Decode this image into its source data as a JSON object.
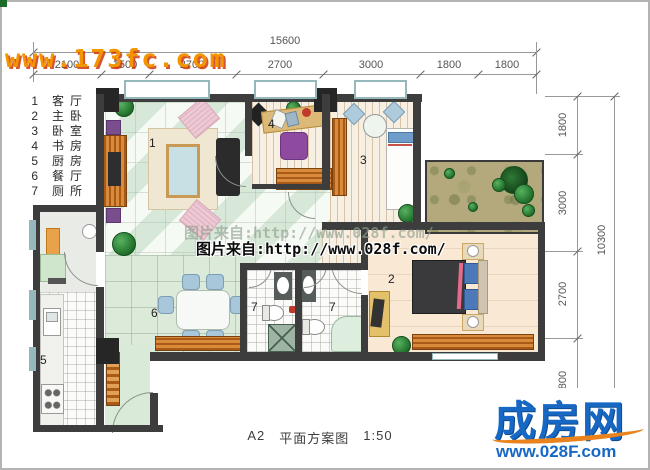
{
  "watermarks": {
    "site_top_left": "www.173fc.com",
    "source_center": "图片来自:http://www.028f.com/"
  },
  "legend": {
    "items": [
      {
        "num": "1",
        "label": "客厅"
      },
      {
        "num": "2",
        "label": "主卧"
      },
      {
        "num": "3",
        "label": "卧室"
      },
      {
        "num": "4",
        "label": "书房"
      },
      {
        "num": "5",
        "label": "厨房"
      },
      {
        "num": "6",
        "label": "餐厅"
      },
      {
        "num": "7",
        "label": "厕所"
      }
    ]
  },
  "dimensions": {
    "top": {
      "total": "15600",
      "segments": [
        "2100",
        "1500",
        "2700",
        "2700",
        "3000",
        "1800",
        "1800"
      ]
    },
    "right": {
      "total": "10300",
      "segments": [
        "1800",
        "3000",
        "2700",
        "800"
      ]
    }
  },
  "rooms": {
    "living": "1",
    "master": "2",
    "bedroom2": "3",
    "study": "4",
    "kitchen": "5",
    "dining": "6",
    "bath_left": "7",
    "bath_right": "7"
  },
  "footer": {
    "code": "A2",
    "title": "平面方案图",
    "scale": "1:50"
  },
  "logo": {
    "brand": "成房网",
    "site": "www.028F.com"
  },
  "colors": {
    "wall": "#3d3d3d",
    "window_frame": "#96b7bc",
    "wood": "#c06a1e",
    "logo_blue": "#1668c4",
    "logo_orange": "#e8831d",
    "watermark_orange": "#f29500"
  }
}
